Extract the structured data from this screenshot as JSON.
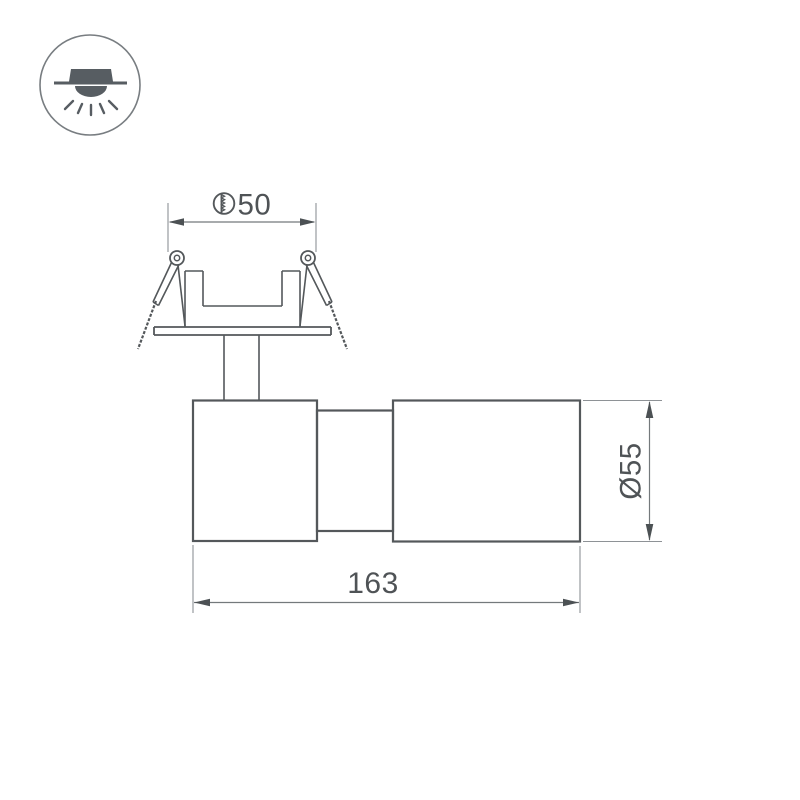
{
  "canvas": {
    "width": 800,
    "height": 800,
    "background": "#ffffff"
  },
  "icon": {
    "name": "recessed-ceiling-downlight",
    "fill_color": "#575d62",
    "ring_color": "#787d81"
  },
  "drawing": {
    "subject": "recessed-swivel-spotlight-side-view",
    "outline_color": "#54585b",
    "dimension_line_color": "#74797c",
    "extension_line_color": "#8e9296",
    "text_color": "#4f5356"
  },
  "dimensions": {
    "cutout": {
      "symbol": "drill-hole-symbol",
      "value": "50"
    },
    "diameter": {
      "value": "Ø55"
    },
    "length": {
      "value": "163"
    }
  }
}
